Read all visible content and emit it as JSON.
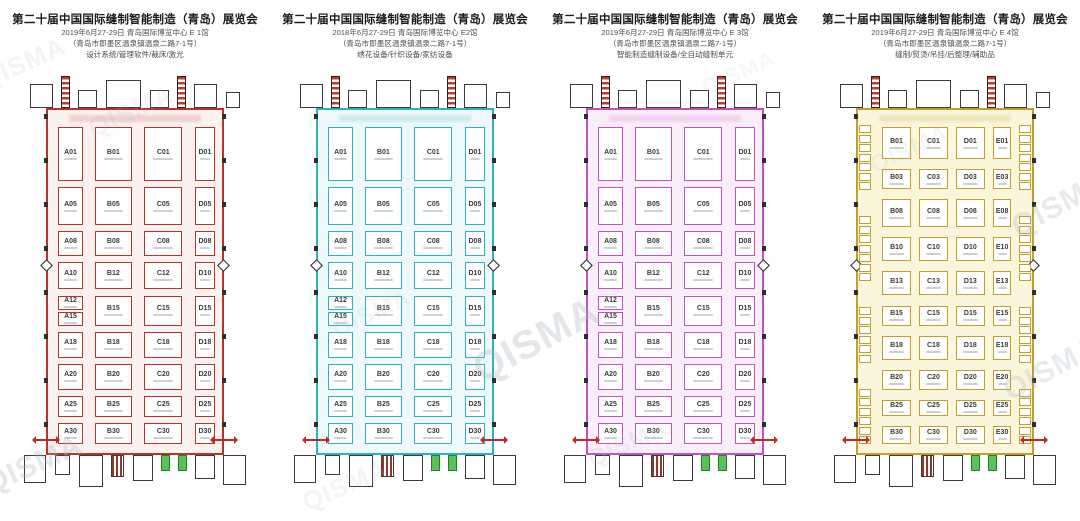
{
  "watermark": {
    "text": "QISMA",
    "color": "#a9b6c0"
  },
  "halls": [
    {
      "hall_label": "E1",
      "title": "第二十届中国国际缝制智能制造（青岛）展览会",
      "date_venue": "2019年6月27-29日 青岛国际博览中心 E 1馆",
      "address": "（青岛市即墨区温泉镇温泉二路7-1号）",
      "categories": "设计系统/管理软件/裁床/激光",
      "accent": "#b5342c",
      "tint": "#fbf1ef",
      "grid": "abcd",
      "rows": [
        [
          "A01",
          "B01",
          "C01",
          "D01"
        ],
        [
          "A05",
          "B05",
          "C05",
          "D05"
        ],
        [
          "A08",
          "B08",
          "C08",
          "D08"
        ],
        [
          "A10",
          "B12",
          "C12",
          "D10"
        ],
        [
          "A12|A15",
          "B15",
          "C15",
          "D15"
        ],
        [
          "A18",
          "B18",
          "C18",
          "D18"
        ],
        [
          "A20",
          "B20",
          "C20",
          "D20"
        ],
        [
          "A25",
          "B25",
          "C25",
          "D25"
        ],
        [
          "A30",
          "B30",
          "C30",
          "D30"
        ]
      ]
    },
    {
      "hall_label": "E2",
      "title": "第二十届中国国际缝制智能制造（青岛）展览会",
      "date_venue": "2018年6月27-29日 青岛国际博览中心 E2馆",
      "address": "（青岛市即墨区温泉镇温泉二路7-1号）",
      "categories": "绣花设备/针织设备/家纺设备",
      "accent": "#2fafc2",
      "tint": "#edf9fa",
      "grid": "abcd",
      "rows": [
        [
          "A01",
          "B01",
          "C01",
          "D01"
        ],
        [
          "A05",
          "B05",
          "C05",
          "D05"
        ],
        [
          "A08",
          "B08",
          "C08",
          "D08"
        ],
        [
          "A10",
          "B12",
          "C12",
          "D10"
        ],
        [
          "A12|A15",
          "B15",
          "C15",
          "D15"
        ],
        [
          "A18",
          "B18",
          "C18",
          "D18"
        ],
        [
          "A20",
          "B20",
          "C20",
          "D20"
        ],
        [
          "A25",
          "B25",
          "C25",
          "D25"
        ],
        [
          "A30",
          "B30",
          "C30",
          "D30"
        ]
      ]
    },
    {
      "hall_label": "E3",
      "title": "第二十届中国国际缝制智能制造（青岛）展览会",
      "date_venue": "2019年6月27-29日 青岛国际博览中心 E 3馆",
      "address": "（青岛市即墨区温泉镇温泉二路7-1号）",
      "categories": "智能制造缝制设备/全自动缝制单元",
      "accent": "#bf52bd",
      "tint": "#faeefa",
      "grid": "abcd",
      "rows": [
        [
          "A01",
          "B01",
          "C01",
          "D01"
        ],
        [
          "A05",
          "B05",
          "C05",
          "D05"
        ],
        [
          "A08",
          "B08",
          "C08",
          "D08"
        ],
        [
          "A10",
          "B12",
          "C12",
          "D10"
        ],
        [
          "A12|A15",
          "B15",
          "C15",
          "D15"
        ],
        [
          "A18",
          "B18",
          "C18",
          "D18"
        ],
        [
          "A20",
          "B20",
          "C20",
          "D20"
        ],
        [
          "A25",
          "B25",
          "C25",
          "D25"
        ],
        [
          "A30",
          "B30",
          "C30",
          "D30"
        ]
      ]
    },
    {
      "hall_label": "E4",
      "title": "第二十届中国国际缝制智能制造（青岛）展览会",
      "date_venue": "2019年6月27-29日 青岛国际博览中心 E 4馆",
      "address": "（青岛市即墨区温泉镇温泉二路7-1号）",
      "categories": "缝制/熨烫/吊挂/后整理/辅助品",
      "accent": "#c0a02b",
      "tint": "#fbf5dc",
      "grid": "bcde",
      "rows": [
        [
          "B01",
          "C01",
          "D01",
          "E01"
        ],
        [
          "B03",
          "C03",
          "D03",
          "E03"
        ],
        [
          "B08",
          "C08",
          "D08",
          "E08"
        ],
        [
          "B10",
          "C10",
          "D10",
          "E10"
        ],
        [
          "B13",
          "C13",
          "D13",
          "E13"
        ],
        [
          "B15",
          "C15",
          "D15",
          "E15"
        ],
        [
          "B18",
          "C18",
          "D18",
          "E18"
        ],
        [
          "B20",
          "C20",
          "D20",
          "E20"
        ],
        [
          "B25",
          "C25",
          "D25",
          "E25"
        ],
        [
          "B30",
          "C30",
          "D30",
          "E30"
        ]
      ],
      "side_strip_cells": {
        "left": [
          7,
          7,
          6,
          6
        ],
        "right": [
          7,
          7,
          6,
          6
        ]
      }
    }
  ]
}
